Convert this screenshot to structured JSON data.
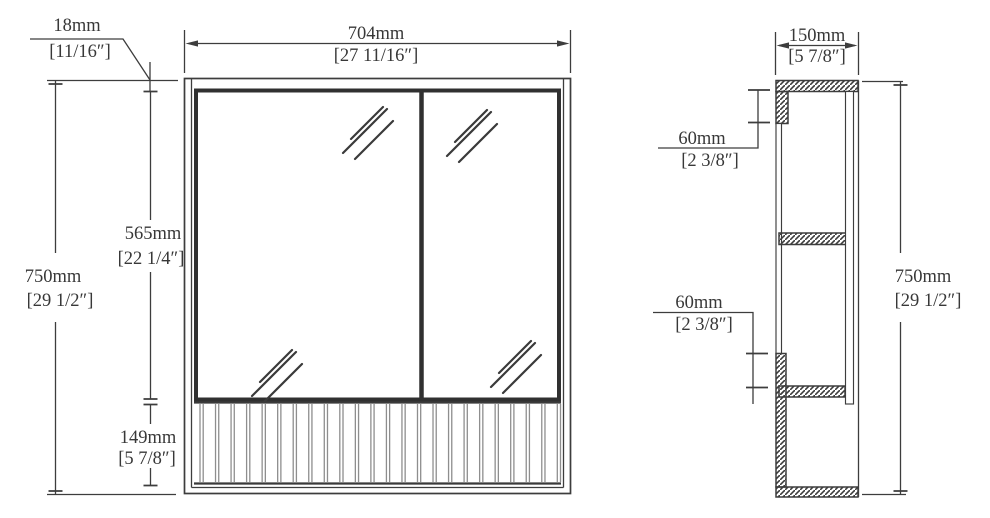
{
  "front_view": {
    "dim_panel_thickness": {
      "mm": "18mm",
      "inch": "[11/16″]"
    },
    "dim_width": {
      "mm": "704mm",
      "inch": "[27 11/16″]"
    },
    "dim_height": {
      "mm": "750mm",
      "inch": "[29 1/2″]"
    },
    "dim_mirror_height": {
      "mm": "565mm",
      "inch": "[22 1/4″]"
    },
    "dim_shelf_height": {
      "mm": "149mm",
      "inch": "[5 7/8″]"
    },
    "slat_count": 24
  },
  "side_view": {
    "dim_depth": {
      "mm": "150mm",
      "inch": "[5 7/8″]"
    },
    "dim_top_inset": {
      "mm": "60mm",
      "inch": "[2 3/8″]"
    },
    "dim_bottom_inset": {
      "mm": "60mm",
      "inch": "[2 3/8″]"
    },
    "dim_height": {
      "mm": "750mm",
      "inch": "[29 1/2″]"
    }
  },
  "colors": {
    "line": "#3d3d3d",
    "slat": "#8e8e8e",
    "text": "#383838",
    "background": "#ffffff"
  }
}
